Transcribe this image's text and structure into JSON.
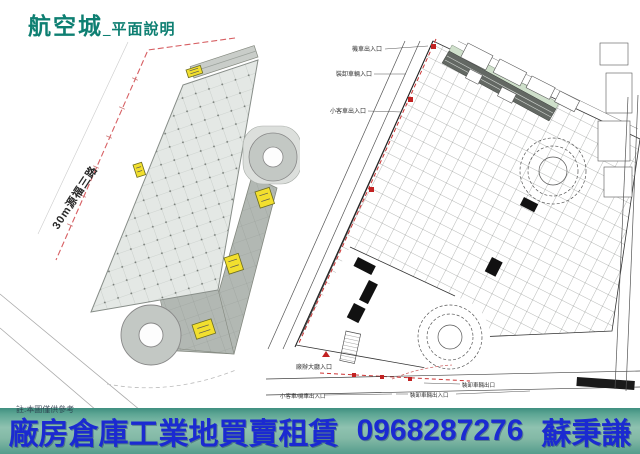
{
  "title": {
    "main": "航空城",
    "sub": "_平面說明"
  },
  "left_plan": {
    "road_label": "30m源福三路"
  },
  "right_plan": {
    "entry_labels": {
      "motorcycle": "機車出入口",
      "loading_in": "裝卸車輛入口",
      "car": "小客車出入口",
      "lobby": "廠辦大廳入口",
      "car_motorcycle": "小客車/機車出入口",
      "loading_inout": "裝卸車輛出入口",
      "loading_out": "裝卸車輛出口"
    }
  },
  "banner": {
    "business": "廠房倉庫工業地買賣租賃",
    "phone": "0968287276",
    "agent": "蘇秉謙",
    "fine_print": "註:本圖僅供參考"
  },
  "colors": {
    "title_teal": "#0e7f72",
    "banner_text_blue": "#1b2ad1",
    "boundary_red": "#cc4444",
    "marker_yellow": "#f2df2e"
  }
}
